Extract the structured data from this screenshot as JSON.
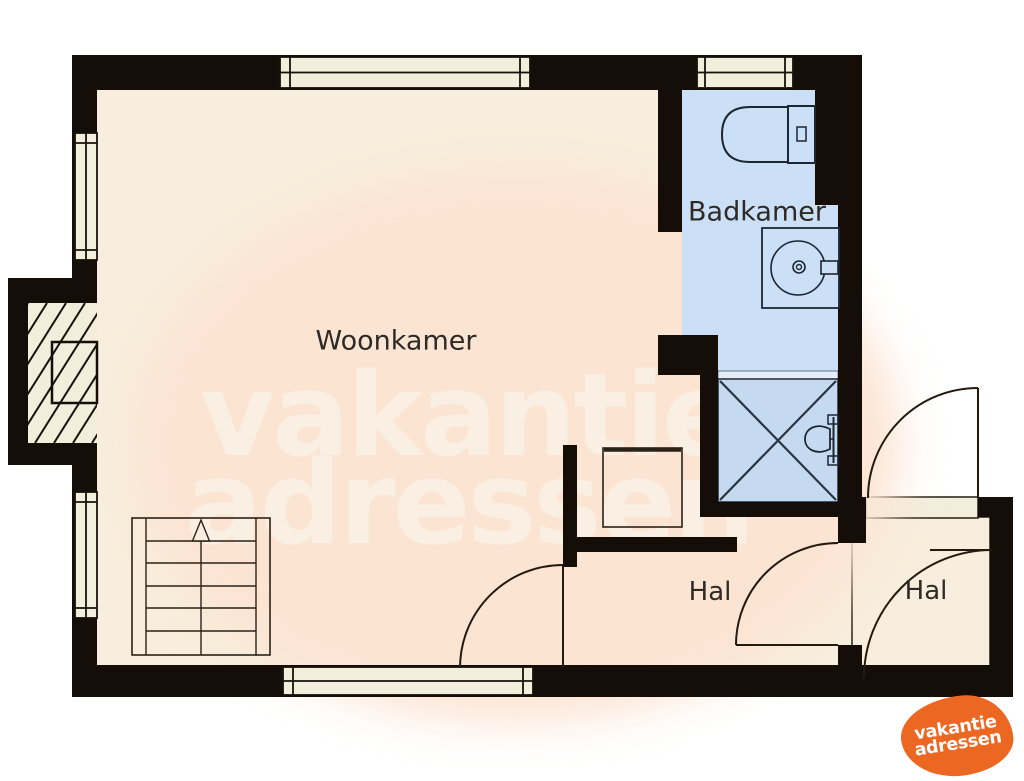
{
  "floorplan": {
    "rooms": {
      "living_room": "Woonkamer",
      "bathroom": "Badkamer",
      "hall_1": "Hal",
      "hall_2": "Hal"
    },
    "watermark": {
      "line1": "vakantie",
      "line2": "adressen"
    },
    "logo": {
      "line1": "vakantie",
      "line2": "adressen"
    },
    "colors": {
      "wall": "#150e08",
      "floor": "#f7eedd",
      "window_fill": "#f3eddc",
      "bathroom_floor": "#cbdff6",
      "shower_floor": "#c5d9f1",
      "fixture_line": "#1d2633",
      "door_line": "#241b10",
      "watermark_blob": "#fce4d3",
      "watermark_text": "#f9efe2",
      "label_text": "#2e2a26",
      "logo_orange": "#ec6722",
      "logo_text": "#ffffff",
      "outside": "#ffffff"
    }
  }
}
